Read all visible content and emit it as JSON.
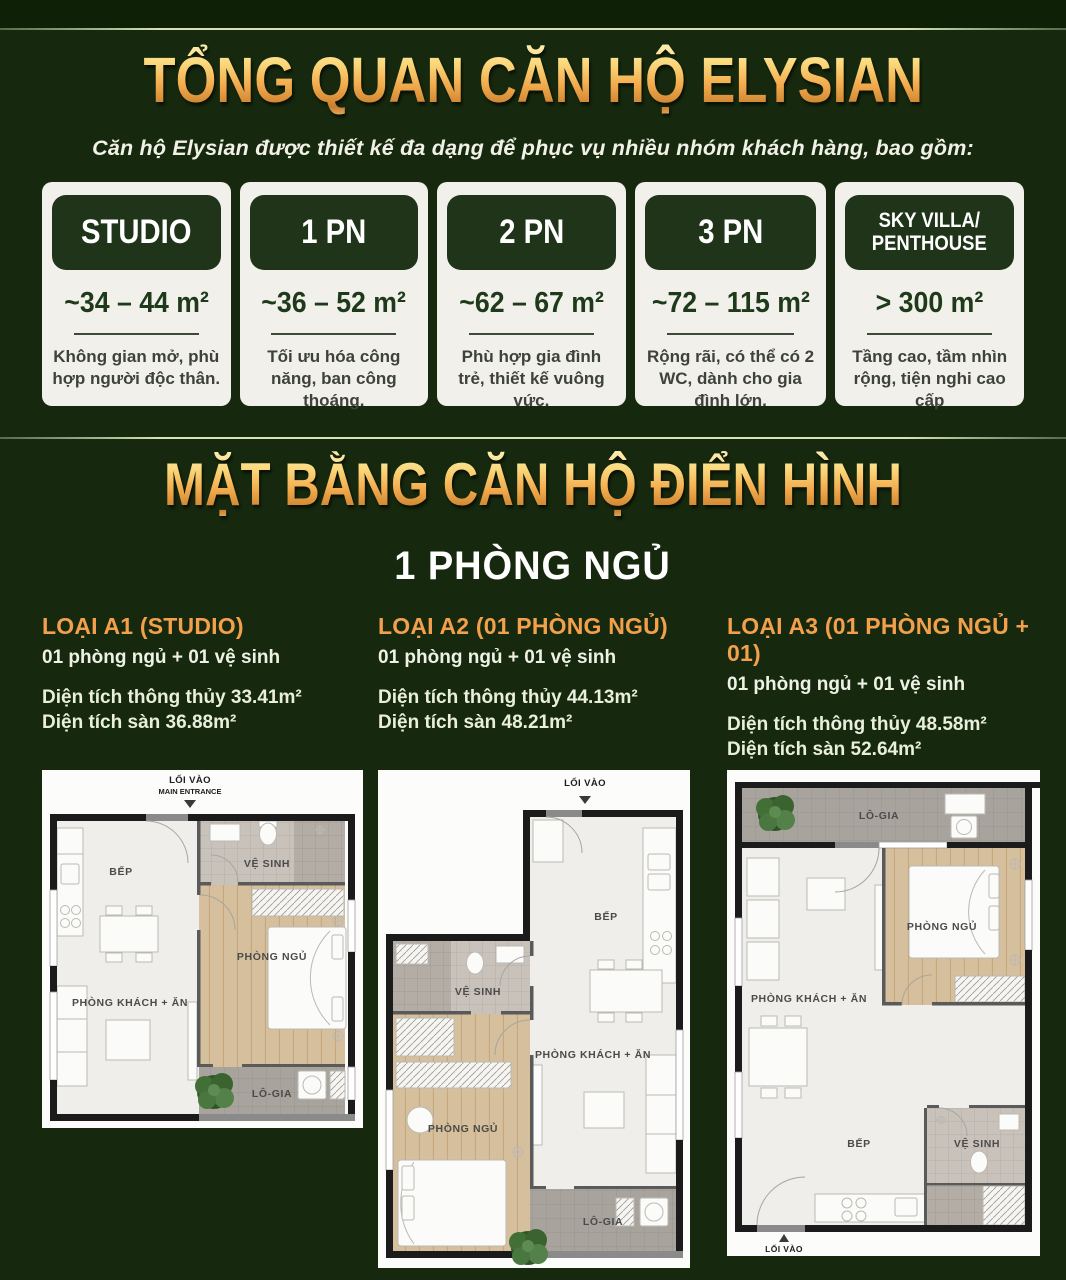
{
  "colors": {
    "background": "#16290e",
    "top_band": "#0e2107",
    "gold_accent": "#f2b45a",
    "card_header_green": "#1f3418",
    "card_background": "#f1f0eb",
    "heading_orange": "#f2a04b"
  },
  "overview": {
    "title": "TỔNG QUAN CĂN HỘ ELYSIAN",
    "subtitle": "Căn hộ Elysian được thiết kế đa dạng để phục vụ nhiều nhóm khách hàng, bao gồm:",
    "cards": [
      {
        "title": "STUDIO",
        "area": "~34 – 44 m²",
        "desc": "Không gian mở, phù hợp người độc thân."
      },
      {
        "title": "1 PN",
        "area": "~36 – 52 m²",
        "desc": "Tối ưu hóa công năng, ban công thoáng."
      },
      {
        "title": "2 PN",
        "area": "~62 – 67 m²",
        "desc": "Phù hợp gia đình trẻ, thiết kế vuông vức."
      },
      {
        "title": "3 PN",
        "area": "~72 – 115 m²",
        "desc": "Rộng rãi, có thể có 2 WC, dành cho gia đình lớn."
      },
      {
        "title": "SKY VILLA/ PENTHOUSE",
        "area": "> 300 m²",
        "desc": "Tầng cao, tầm nhìn rộng, tiện nghi cao cấp"
      }
    ]
  },
  "floor_section": {
    "title": "MẶT BẰNG CĂN HỘ ĐIỂN HÌNH",
    "subtitle": "1 PHÒNG NGỦ",
    "plans": [
      {
        "heading": "LOẠI A1 (STUDIO)",
        "layout": "01 phòng ngủ + 01 vệ sinh",
        "area_net": "Diện tích thông thủy 33.41m²",
        "area_gross": "Diện tích sàn 36.88m²",
        "entrance_vi": "LỐI VÀO",
        "entrance_en": "MAIN ENTRANCE",
        "rooms": {
          "kitchen": "BẾP",
          "bathroom": "VỆ SINH",
          "bedroom": "PHÒNG NGỦ",
          "living": "PHÒNG KHÁCH + ĂN",
          "loggia": "LÔ-GIA"
        }
      },
      {
        "heading": "LOẠI A2 (01 PHÒNG NGỦ)",
        "layout": "01 phòng ngủ + 01 vệ sinh",
        "area_net": "Diện tích thông thủy 44.13m²",
        "area_gross": "Diện tích sàn 48.21m²",
        "entrance_vi": "LỐI VÀO",
        "rooms": {
          "kitchen": "BẾP",
          "bathroom": "VỆ SINH",
          "bedroom": "PHÒNG NGỦ",
          "living": "PHÒNG KHÁCH + ĂN",
          "loggia": "LÔ-GIA"
        }
      },
      {
        "heading": "LOẠI A3 (01 PHÒNG NGỦ + 01)",
        "layout": "01 phòng ngủ + 01 vệ sinh",
        "area_net": "Diện tích thông thủy 48.58m²",
        "area_gross": "Diện tích sàn 52.64m²",
        "entrance_vi": "LỐI VÀO",
        "rooms": {
          "kitchen": "BẾP",
          "bathroom": "VỆ SINH",
          "bedroom": "PHÒNG NGỦ",
          "living": "PHÒNG KHÁCH + ĂN",
          "loggia": "LÔ-GIA"
        }
      }
    ]
  }
}
